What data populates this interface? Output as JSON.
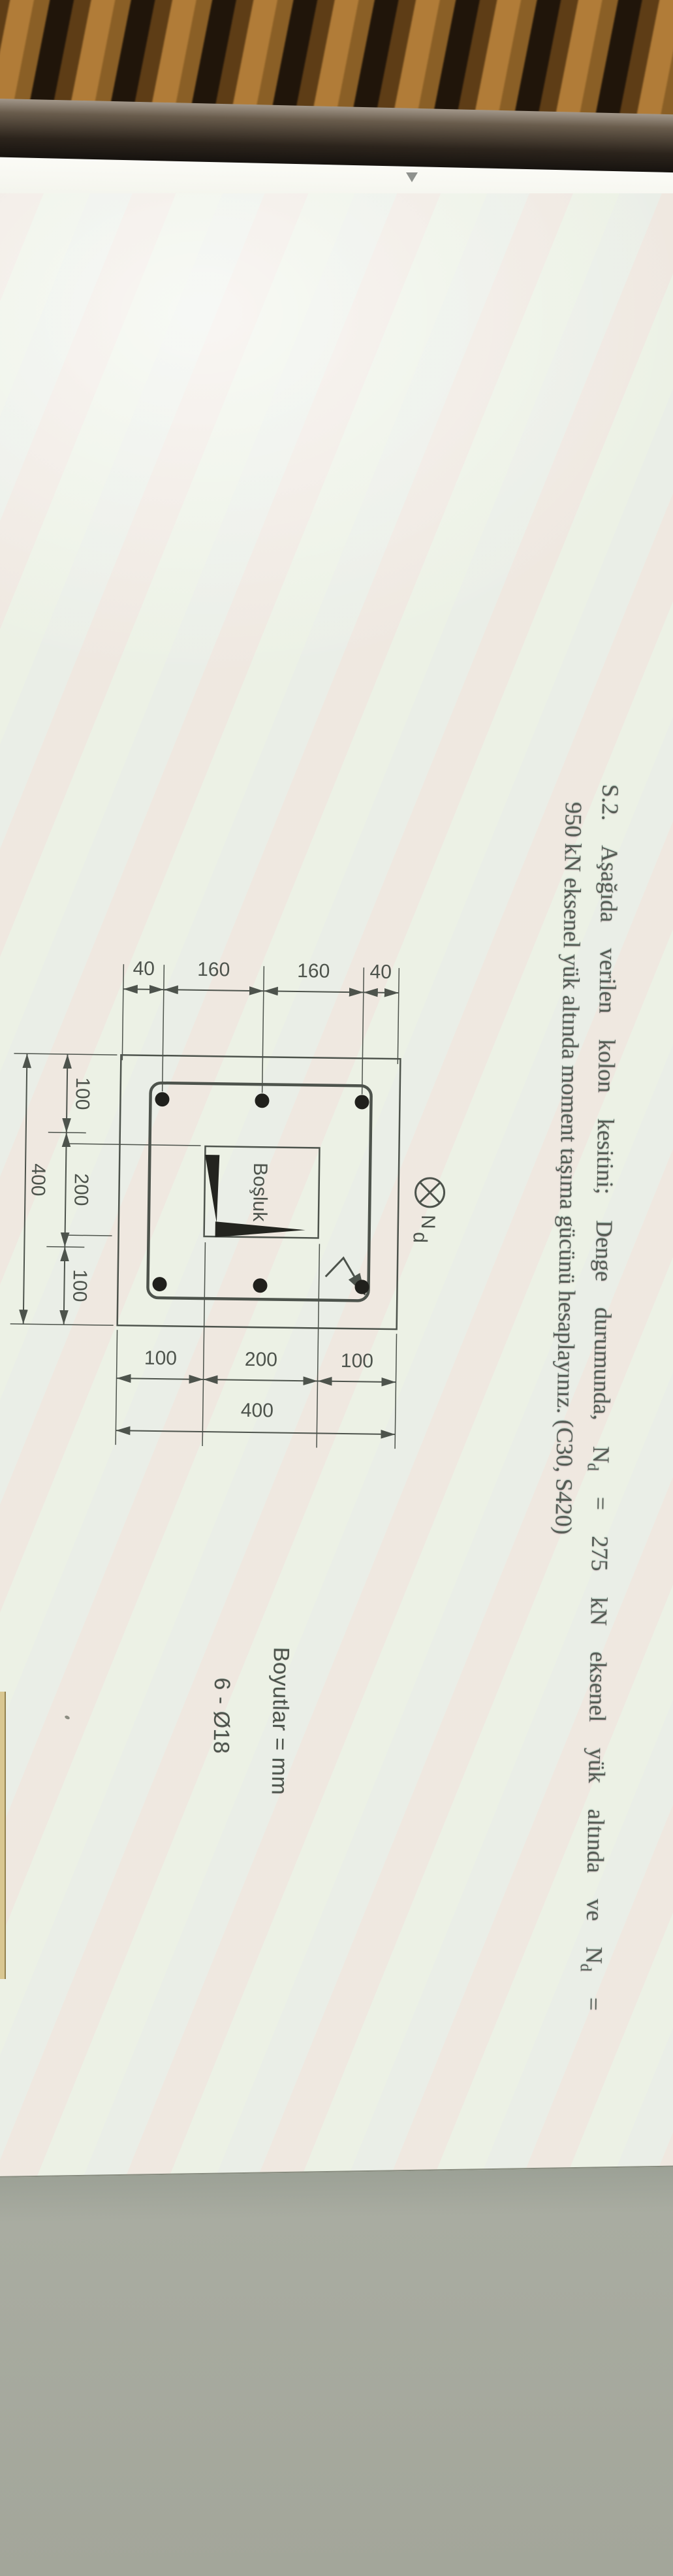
{
  "scene": {
    "desk": {
      "stripe_dark": "#20150a",
      "stripe_light": "#b17c38"
    },
    "bezel_color": "#17120e",
    "top_strip": {
      "color": "#f9faf3",
      "chevron_color": "#8f928e"
    },
    "screen": {
      "page_color": "#edefe5",
      "backdrop_color": "#a8aba0",
      "ink_color": "#4d534c",
      "text_color": "#565c55",
      "adjacent_page_edge_color": "#d9c791"
    }
  },
  "page": {
    "problem": {
      "line1_segments": [
        {
          "t": "S.2. Aşağıda verilen kolon kesitini;  Denge durumunda, N"
        },
        {
          "sub": "d"
        },
        {
          "t": " = 275 kN eksenel yük altında ve N"
        },
        {
          "sub": "d"
        },
        {
          "t": " ="
        }
      ],
      "line2": "950 kN eksenel yük altında moment taşıma gücünü hesaplayınız. (C30, S420)"
    },
    "load_symbol": {
      "label": "N",
      "sub": "d"
    },
    "notes": {
      "units": "Boyutlar = mm",
      "rebar_schedule": "6 - Ø18"
    },
    "diagram": {
      "void_label": "Boşluk",
      "left_dims": [
        "40",
        "160",
        "160",
        "40"
      ],
      "right_dims": [
        "100",
        "200",
        "100"
      ],
      "right_total": "400",
      "bottom_dims": [
        "100",
        "200",
        "100"
      ],
      "bottom_total": "400",
      "bar_count": 6
    }
  }
}
